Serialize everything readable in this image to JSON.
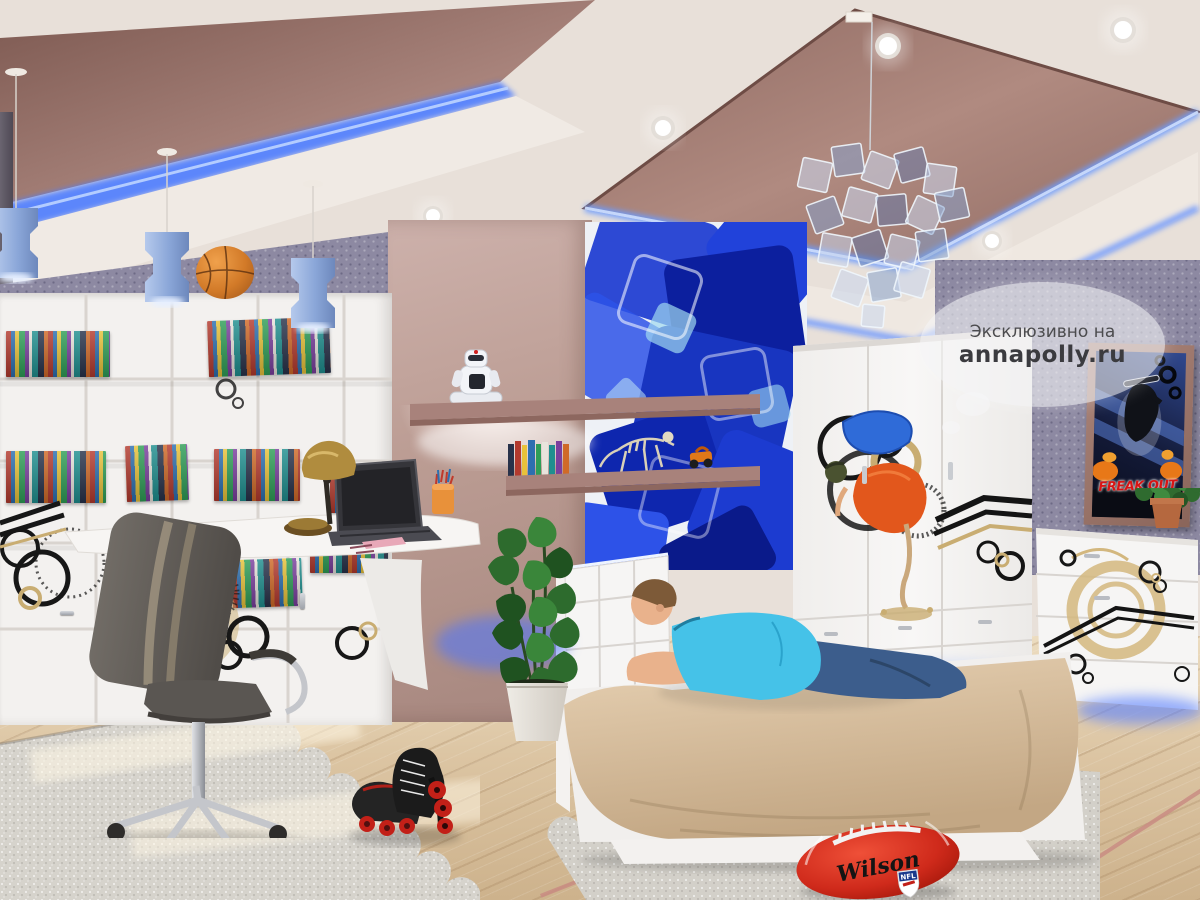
{
  "render": {
    "type": "3D interior render",
    "room": "teen boy's bedroom with multi-level mauve ceiling and blue LED strips",
    "description": "A boy in a light-blue polo shirt and jeans lies on a beige-covered single bed. White furniture decorated with black and gold street-art decals: corner bookshelf unit with colorful books, curved desk with laptop and brass lamp, gray office chair, three-door wardrobe with an orange-and-blue breakdancer graphic, chest of drawers. Center wall carries a mural of blue 3D glass cubes with mauve floating shelves holding a robot toy and a dinosaur skeleton. Blue pendant lamps, mirrored-cube chandelier, basketball on the shelf, monstera plant, inline skates and a red Wilson football on a light wood floor with a scalloped gray rug."
  },
  "watermark": {
    "line1": "Эксклюзивно на",
    "line2": "annapolly.ru"
  },
  "poster": {
    "title": "FREAK OUT"
  },
  "football": {
    "brand": "Wilson",
    "shield_label": "NFL"
  },
  "palette": {
    "ceiling_cream": "#e8e0d9",
    "ceiling_mauve": "#96706a",
    "led_blue": "#5d8dff",
    "wallpaper_violet": "#8d89a2",
    "divider_mauve": "#c2a49e",
    "furniture_white": "#f4f2f0",
    "mural_blue": "#1b38c4",
    "bedspread_beige": "#d8c1a3",
    "floor_wood": "#dcc6a6",
    "rug_gray": "#d6d3cc",
    "shirt_cyan": "#45c2e8",
    "jeans_blue": "#3c5d8c",
    "football_red": "#cf2a1b",
    "decal_gold": "#c9ad72",
    "decal_black": "#191919"
  },
  "objects": [
    {
      "name": "pendant-lights",
      "desc": "three blue faceted pendant lamps on wires"
    },
    {
      "name": "basketball",
      "desc": "orange basketball on top of the shelf unit"
    },
    {
      "name": "bookshelf-unit",
      "desc": "white cube bookshelf with colorful books and circle decals"
    },
    {
      "name": "desk",
      "desc": "white curved desk with laptop, brass lamp, pencil cup"
    },
    {
      "name": "office-chair",
      "desc": "gray swivel chair with chrome star base"
    },
    {
      "name": "robot-toy",
      "desc": "white toy robot on mauve shelf"
    },
    {
      "name": "dinosaur-skeleton",
      "desc": "toy dinosaur skeleton on floating shelf"
    },
    {
      "name": "cube-mural",
      "desc": "wall mural of blue 3D glass cubes"
    },
    {
      "name": "bed",
      "desc": "white single bed with beige bedspread"
    },
    {
      "name": "boy",
      "desc": "boy in cyan polo shirt and jeans lying on the bed"
    },
    {
      "name": "wardrobe",
      "desc": "white three-door wardrobe with breakdancer decal"
    },
    {
      "name": "dresser",
      "desc": "white chest of drawers with gold circle decal and plant"
    },
    {
      "name": "poster",
      "desc": "framed FREAK OUT skateboarding poster"
    },
    {
      "name": "monstera-plant",
      "desc": "tall potted monstera between desk and bed"
    },
    {
      "name": "inline-skates",
      "desc": "black inline skates with red wheels"
    },
    {
      "name": "football",
      "desc": "red Wilson NFL football on the floor"
    },
    {
      "name": "chandelier",
      "desc": "chandelier of mirrored glass squares"
    },
    {
      "name": "rug",
      "desc": "light gray shaggy rug with scalloped lace edge"
    }
  ]
}
